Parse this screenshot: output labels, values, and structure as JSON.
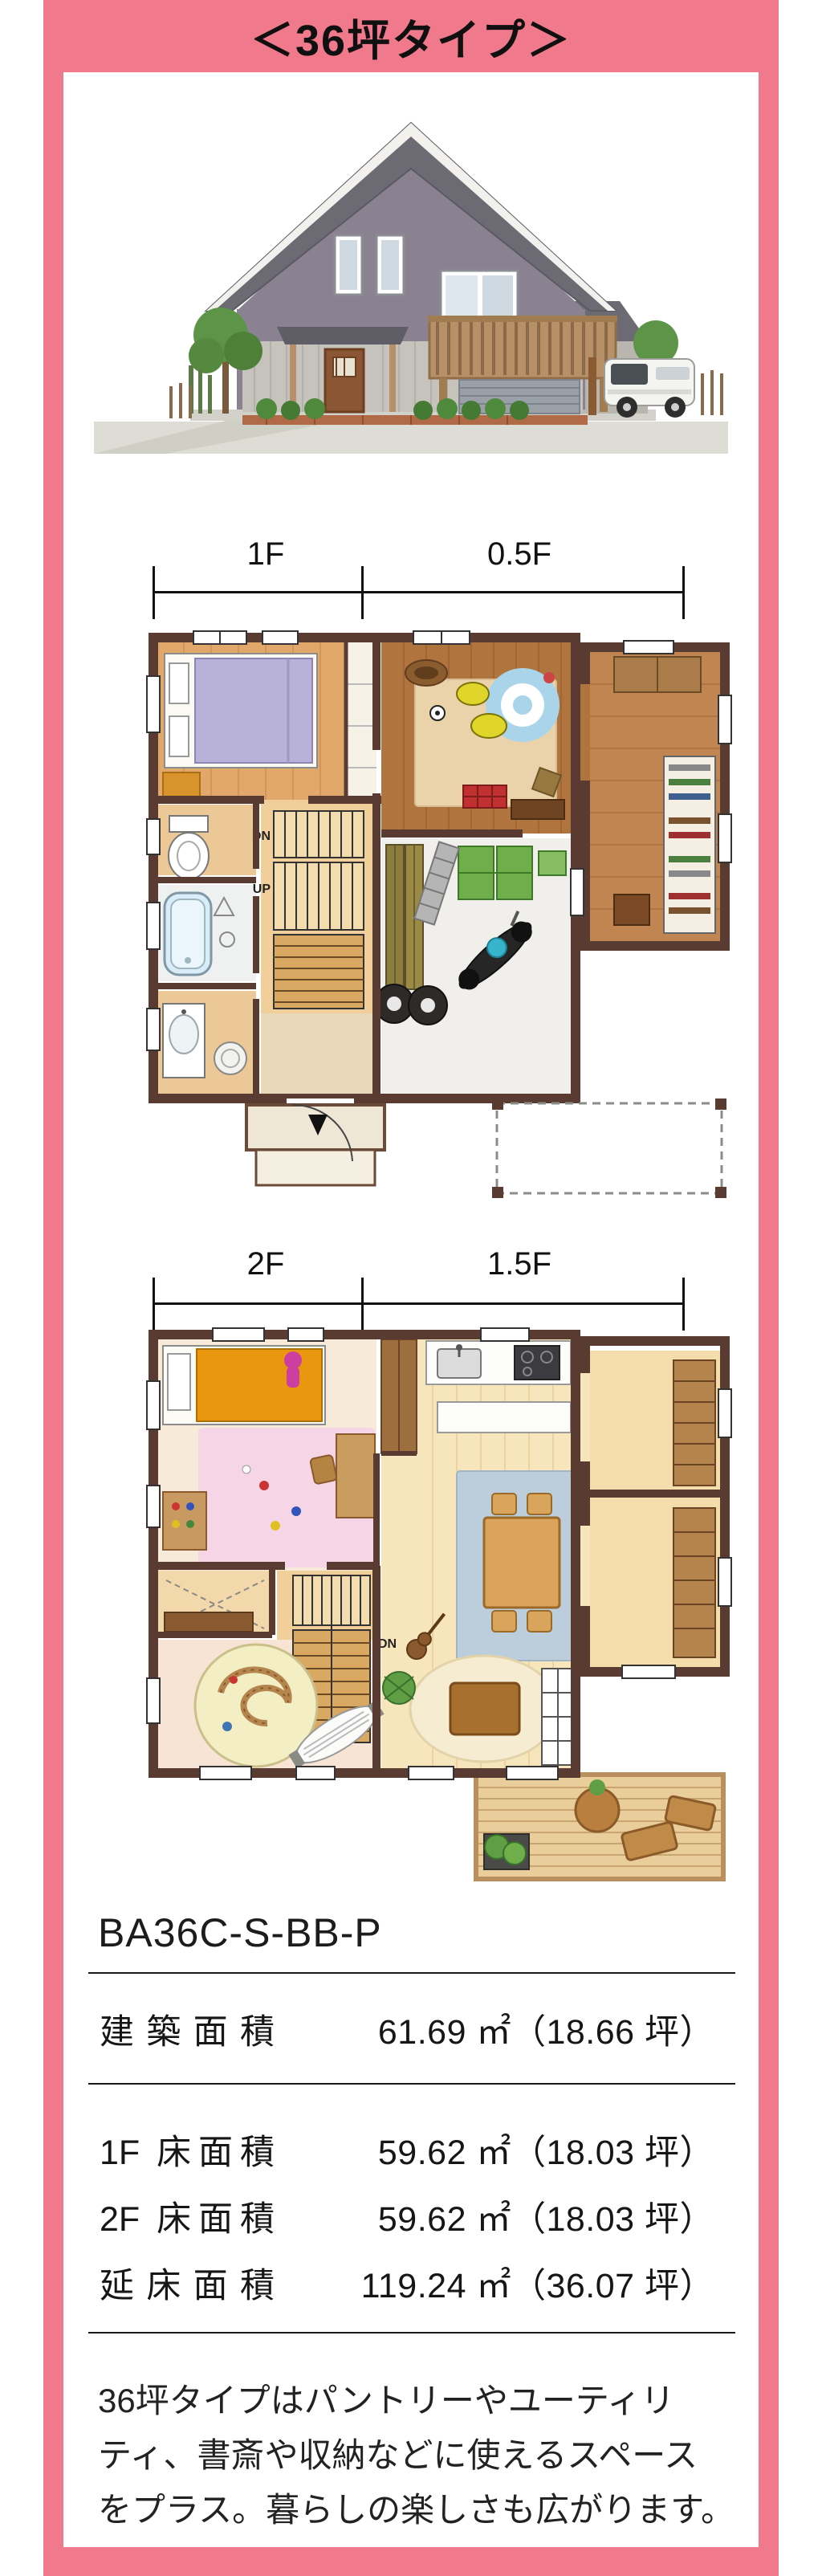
{
  "accent": {
    "pink": "#f0798b",
    "wall_brown": "#5a3b31"
  },
  "header": {
    "title": "＜36坪タイプ＞"
  },
  "floor1": {
    "dim_left": "1F",
    "dim_right": "0.5F",
    "up": "UP",
    "dn": "DN"
  },
  "floor2": {
    "dim_left": "2F",
    "dim_right": "1.5F",
    "dn": "DN"
  },
  "model": {
    "code": "BA36C-S-BB-P"
  },
  "area_table": {
    "building": {
      "label": "建築面積",
      "value": "61.69 ㎡（18.66 坪）"
    },
    "rows": [
      {
        "label": "1F 床面積",
        "value": "59.62 ㎡（18.03 坪）"
      },
      {
        "label": "2F 床面積",
        "value": "59.62 ㎡（18.03 坪）"
      },
      {
        "label": "延床面積",
        "value": "119.24 ㎡（36.07 坪）"
      }
    ]
  },
  "description": {
    "lines": [
      "36坪タイプはパントリーやユーティリ",
      "ティ、書斎や収納などに使えるスペース",
      "をプラス。暮らしの楽しさも広がります。"
    ]
  }
}
